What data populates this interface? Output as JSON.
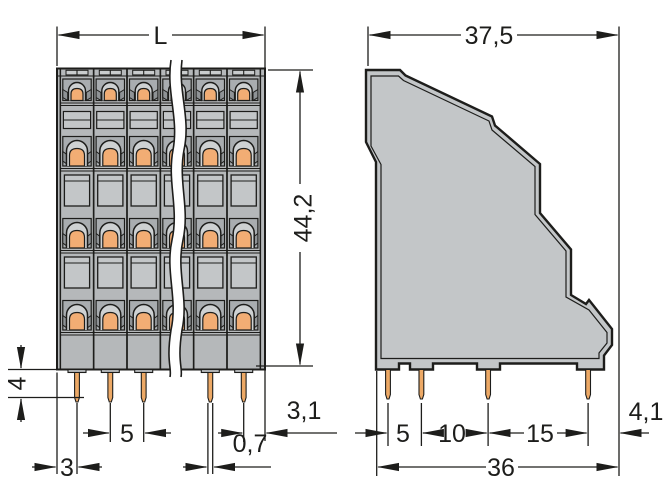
{
  "drawing": {
    "type": "terminal-block-dimensional-drawing",
    "front_view": {
      "dim_total_length": "L",
      "dim_total_height": "44,2",
      "dim_pin_length": "4",
      "dim_pin_pitch": "5",
      "dim_edge_to_first_pin": "3",
      "dim_pin_width": "0,7",
      "dim_last_pin_to_edge": "3,1"
    },
    "side_view": {
      "dim_top_depth": "37,5",
      "dim_pin_row_spacing_1": "5",
      "dim_pin_row_spacing_2": "10",
      "dim_pin_row_spacing_3": "15",
      "dim_last_pin_to_edge": "4,1",
      "dim_total_depth": "36"
    },
    "colors": {
      "background": "#ffffff",
      "outline": "#1d1d1b",
      "body_front": "#b5b8ba",
      "body_side": "#c3c6c8",
      "recess": "#a9adb0",
      "dome": "#ced1d2",
      "window": "#c3c6c8",
      "cap": "#c9cccd",
      "clamp_spring": "#f2ad74",
      "pin": "#eda966"
    }
  }
}
